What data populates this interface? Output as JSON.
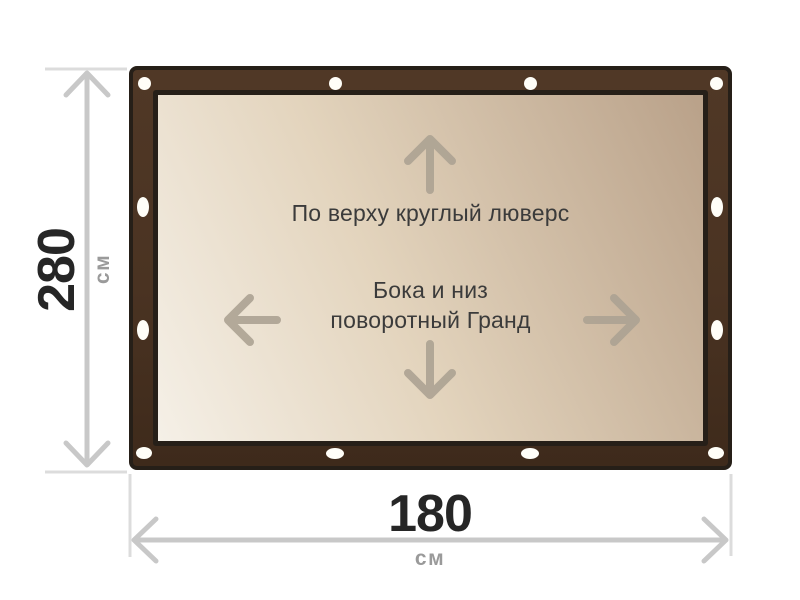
{
  "diagram": {
    "kind": "banner-size-diagram",
    "canvas_note_top": "По верху круглый люверс",
    "canvas_note_middle": [
      "Бока и низ",
      "поворотный Гранд"
    ]
  },
  "height_dimension": {
    "value": "280",
    "unit": "см"
  },
  "width_dimension": {
    "value": "180",
    "unit": "см"
  },
  "icons": {
    "arrow_up": "↑",
    "arrow_down": "↓",
    "arrow_left": "←",
    "arrow_right": "→",
    "grommet": "⬭"
  },
  "colors": {
    "frame_brown": "#4a3322",
    "frame_outline": "#261f18",
    "tarp_gradient_light": "#f5f0e7",
    "tarp_gradient_dark": "#b9a189",
    "inner_arrow": "#aca292",
    "dimension_line": "#c8c8c8",
    "extension_line": "#dcdcdc",
    "note_text": "#3b3b3b",
    "dimension_value": "#262626",
    "dimension_unit": "#9a9a9a",
    "grommet": "#fffef8"
  }
}
